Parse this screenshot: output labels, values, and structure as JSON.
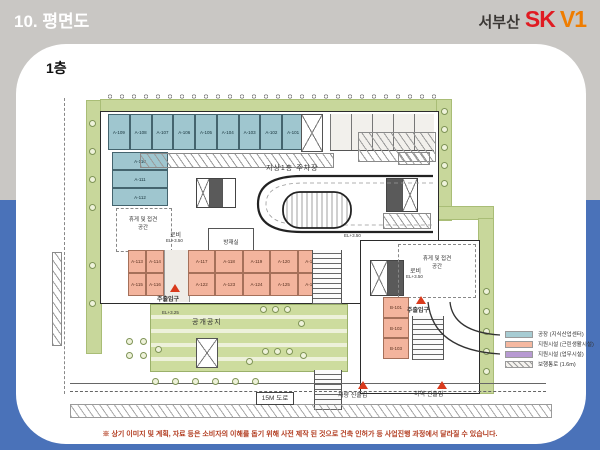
{
  "header": {
    "section_title": "10. 평면도",
    "brand": {
      "region": "서부산",
      "sk": "SK",
      "v1": "V1"
    }
  },
  "floor_label": "1층",
  "plan": {
    "labels": {
      "parking_lot": "지상1층 주차장",
      "lobby": "로비",
      "level_350": "EL+3.50",
      "level_325": "EL+3.25",
      "mech_room": "방재실",
      "rest_line1": "휴게 및 접견",
      "rest_line2": "공간",
      "main_entrance": "주출입구",
      "open_space": "공개공지",
      "road": "15M 도로",
      "vehicle_access": "차량 진출입",
      "loading_access": "하역 진출입"
    },
    "units": {
      "top_row": [
        "A-109",
        "A-108",
        "A-107",
        "A-106",
        "A-105",
        "A-104",
        "A-103",
        "A-102",
        "A-101"
      ],
      "left_col": [
        "A-110",
        "A-111",
        "A-112"
      ],
      "orange_left": [
        "A-113",
        "A-114",
        "A-115",
        "A-116"
      ],
      "orange_right": [
        "A-117",
        "A-118",
        "A-119",
        "A-120",
        "A-121",
        "A-122",
        "A-123",
        "A-124",
        "A-125",
        "A-126"
      ],
      "b_col": [
        "B-101",
        "B-102",
        "B-103"
      ]
    }
  },
  "legend": {
    "items": [
      {
        "label": "공장 (지식산업센터)",
        "color": "#a7ccd3"
      },
      {
        "label": "지원시설 (근린생활시설)",
        "color": "#f5b8a0"
      },
      {
        "label": "지원시설 (업무시설)",
        "color": "#b79ad2"
      },
      {
        "label": "보행통로 (1.6m)",
        "color": "hatch"
      }
    ]
  },
  "colors": {
    "background_top": "#c9c7c4",
    "background_bottom": "#4a72b9",
    "sk_red": "#e01b22",
    "v1_orange": "#ef7d00",
    "unit_teal": "#9fc6cf",
    "unit_orange": "#f3b49d",
    "landscape_green": "#c8d79b",
    "entrance_red": "#d93a1c"
  },
  "disclaimer": "※ 상기 이미지 및 계획, 자료 등은 소비자의 이해를 돕기 위해 사전 제작 된 것으로 건축 인허가 등 사업진행 과정에서 달라질 수 있습니다."
}
